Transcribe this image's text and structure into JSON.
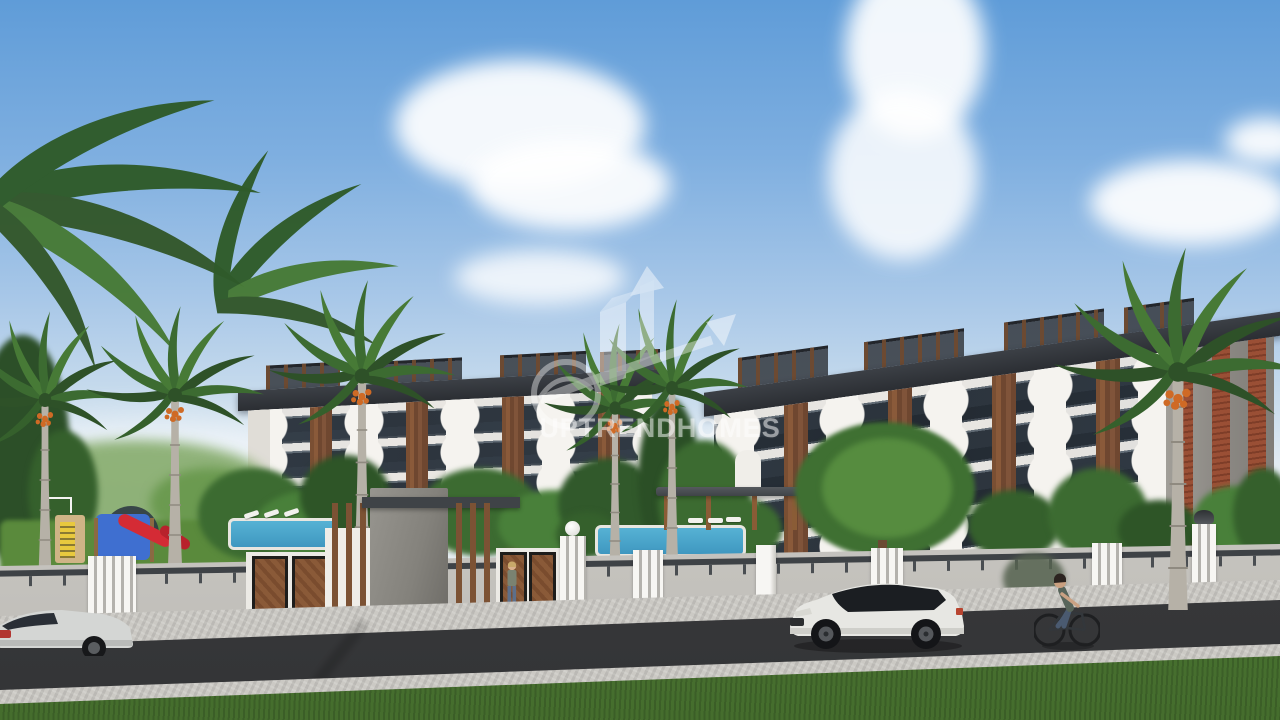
{
  "watermark": {
    "brand_text": "UPTRENDHOMES",
    "logo_icon": "buildings-up-arrow-icon",
    "emblem_icon": "ring-swoosh-icon",
    "color": "#ffffff"
  },
  "scene": {
    "type": "architectural-exterior-render",
    "colors": {
      "sky_top": "#5f9cd8",
      "sky_horizon": "#e6edf3",
      "cloud": "#ffffff",
      "facade_white": "#ece9e4",
      "window_glass": "#242c35",
      "wood_accent": "#7a4f33",
      "roof_dark": "#33373d",
      "brick_accent": "#9a4f35",
      "foliage_dark": "#2e5527",
      "foliage_mid": "#3c6b31",
      "foliage_light": "#6b9a50",
      "pool_water": "#3f97c0",
      "lawn_green": "#5a8a3c",
      "road_asphalt": "#3d3e40",
      "sidewalk_cobble": "#cbc9c4",
      "wall_concrete": "#d6d4cf",
      "fence_white": "#f5f4f1",
      "entrance_concrete": "#8a8a88",
      "suv_body": "#e7e7e3",
      "sedan_body": "#d4d6d4",
      "slide_red": "#d42b35",
      "playground_blue": "#3f6fd0",
      "playground_yellow": "#e8c93e"
    }
  }
}
